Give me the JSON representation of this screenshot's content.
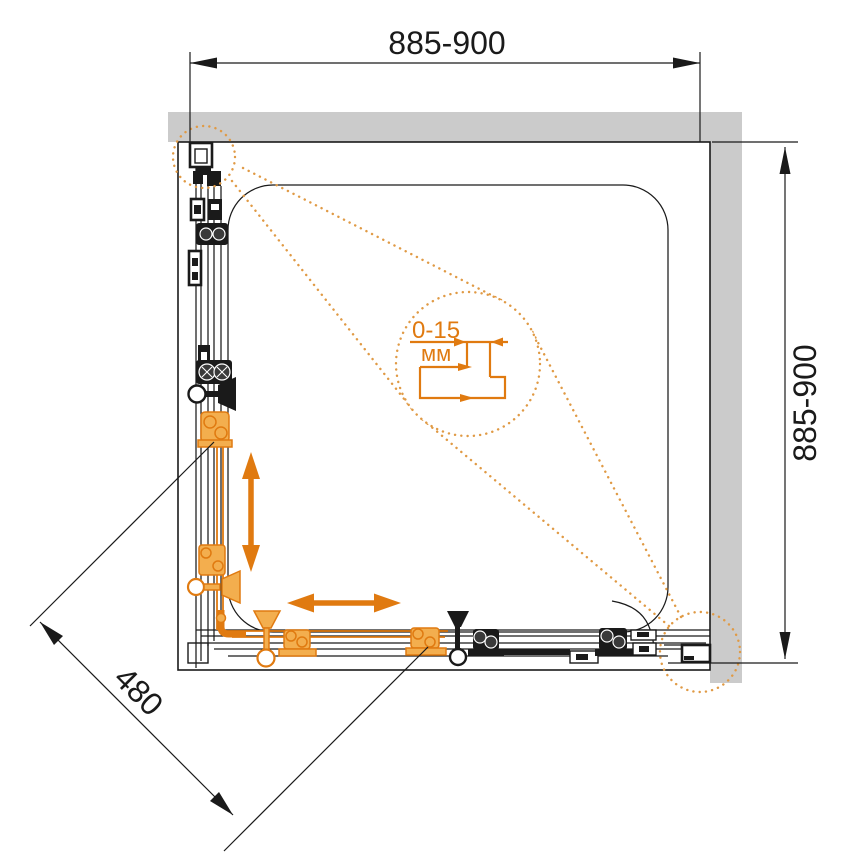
{
  "figure": {
    "dimensions": {
      "top": "885-900",
      "right": "885-900",
      "diagonal": "480",
      "detail_range": "0-15",
      "detail_unit": "мм"
    },
    "icons": {
      "movement_arrow_vertical": "double-arrow-vertical",
      "movement_arrow_horizontal": "double-arrow-horizontal",
      "detail_magnifier": "dotted-circle-callout"
    },
    "colors": {
      "ink": "#1a1a1a",
      "wall": "#cbcbcb",
      "accent": "#e07a10",
      "accent_light": "#f3ae4e",
      "accent_dotted": "#e09a45",
      "background": "#ffffff"
    }
  }
}
